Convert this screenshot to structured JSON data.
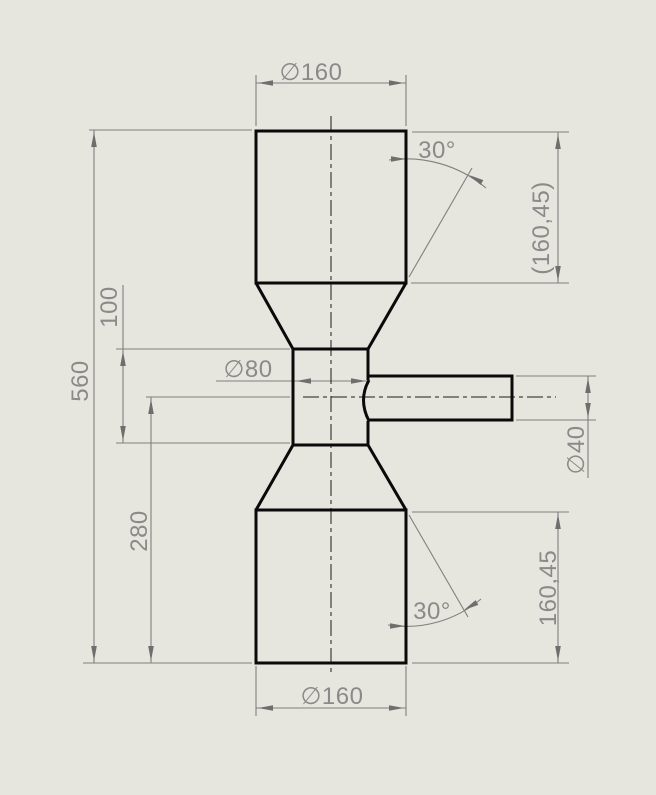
{
  "drawing": {
    "type": "cad-part-drawing",
    "view": "front-section-view",
    "colors": {
      "background": "#e6e6de",
      "part_edges": "#0a0a0a",
      "dimension_lines": "#7f7f7f",
      "dimension_text": "#8a8a8a"
    },
    "dimensions": {
      "top_diameter": "∅160",
      "bottom_diameter": "∅160",
      "neck_diameter": "∅80",
      "stub_diameter": "∅40",
      "top_cylinder_length_reference": "(160,45)",
      "bottom_cylinder_length": "160,45",
      "overall_length": "560",
      "neck_length": "100",
      "stub_axis_to_bottom": "280",
      "top_taper_angle": "30°",
      "bottom_taper_angle": "30°"
    }
  }
}
